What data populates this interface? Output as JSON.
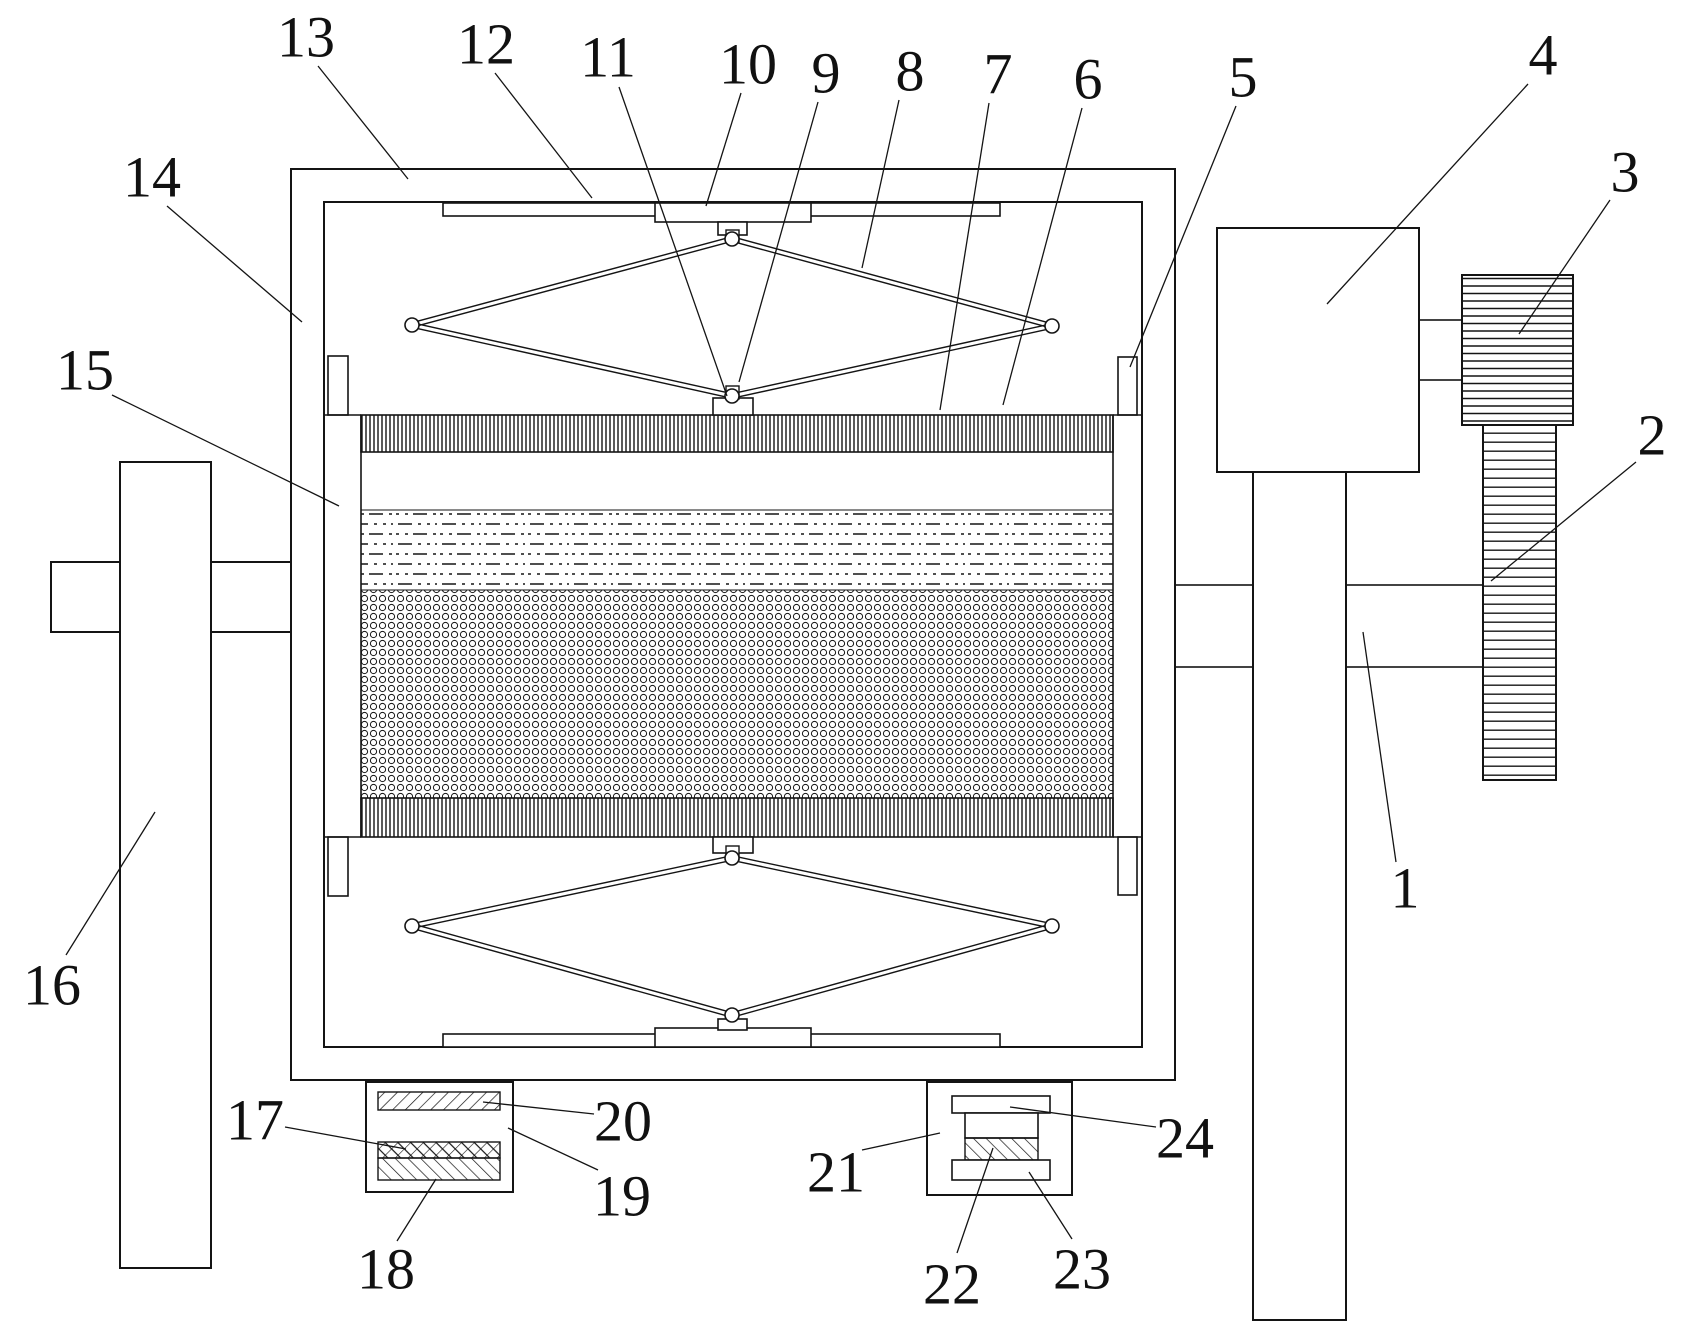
{
  "figure": {
    "type": "patent-line-drawing",
    "background": "#ffffff",
    "line_color": "#141414"
  },
  "labels": [
    {
      "text": "1",
      "x": 1405,
      "y": 888,
      "leader": [
        1396,
        862,
        1363,
        632
      ]
    },
    {
      "text": "2",
      "x": 1652,
      "y": 435,
      "leader": [
        1636,
        462,
        1491,
        581
      ]
    },
    {
      "text": "3",
      "x": 1625,
      "y": 172,
      "leader": [
        1610,
        200,
        1519,
        334
      ]
    },
    {
      "text": "4",
      "x": 1543,
      "y": 55,
      "leader": [
        1528,
        84,
        1327,
        304
      ]
    },
    {
      "text": "5",
      "x": 1243,
      "y": 77,
      "leader": [
        1236,
        106,
        1130,
        367
      ]
    },
    {
      "text": "6",
      "x": 1088,
      "y": 79,
      "leader": [
        1082,
        108,
        1003,
        405
      ]
    },
    {
      "text": "7",
      "x": 998,
      "y": 74,
      "leader": [
        989,
        103,
        940,
        410
      ]
    },
    {
      "text": "8",
      "x": 910,
      "y": 71,
      "leader": [
        899,
        100,
        862,
        268
      ]
    },
    {
      "text": "9",
      "x": 826,
      "y": 73,
      "leader": [
        818,
        102,
        739,
        382
      ]
    },
    {
      "text": "10",
      "x": 748,
      "y": 64,
      "leader": [
        741,
        93,
        706,
        206
      ]
    },
    {
      "text": "11",
      "x": 608,
      "y": 57,
      "leader": [
        619,
        87,
        727,
        396
      ]
    },
    {
      "text": "12",
      "x": 486,
      "y": 44,
      "leader": [
        495,
        73,
        592,
        198
      ]
    },
    {
      "text": "13",
      "x": 306,
      "y": 37,
      "leader": [
        318,
        66,
        408,
        179
      ]
    },
    {
      "text": "14",
      "x": 152,
      "y": 177,
      "leader": [
        167,
        206,
        302,
        322
      ]
    },
    {
      "text": "15",
      "x": 85,
      "y": 370,
      "leader": [
        112,
        395,
        339,
        506
      ]
    },
    {
      "text": "16",
      "x": 52,
      "y": 985,
      "leader": [
        66,
        955,
        155,
        812
      ]
    },
    {
      "text": "17",
      "x": 255,
      "y": 1120,
      "leader": [
        285,
        1127,
        406,
        1149
      ]
    },
    {
      "text": "18",
      "x": 386,
      "y": 1269,
      "leader": [
        397,
        1241,
        436,
        1179
      ]
    },
    {
      "text": "19",
      "x": 622,
      "y": 1196,
      "leader": [
        598,
        1170,
        508,
        1128
      ]
    },
    {
      "text": "20",
      "x": 623,
      "y": 1121,
      "leader": [
        594,
        1114,
        483,
        1102
      ]
    },
    {
      "text": "21",
      "x": 836,
      "y": 1172,
      "leader": [
        862,
        1150,
        940,
        1133
      ]
    },
    {
      "text": "22",
      "x": 952,
      "y": 1284,
      "leader": [
        957,
        1253,
        993,
        1148
      ]
    },
    {
      "text": "23",
      "x": 1082,
      "y": 1269,
      "leader": [
        1072,
        1239,
        1029,
        1172
      ]
    },
    {
      "text": "24",
      "x": 1185,
      "y": 1138,
      "leader": [
        1156,
        1127,
        1010,
        1107
      ]
    }
  ]
}
